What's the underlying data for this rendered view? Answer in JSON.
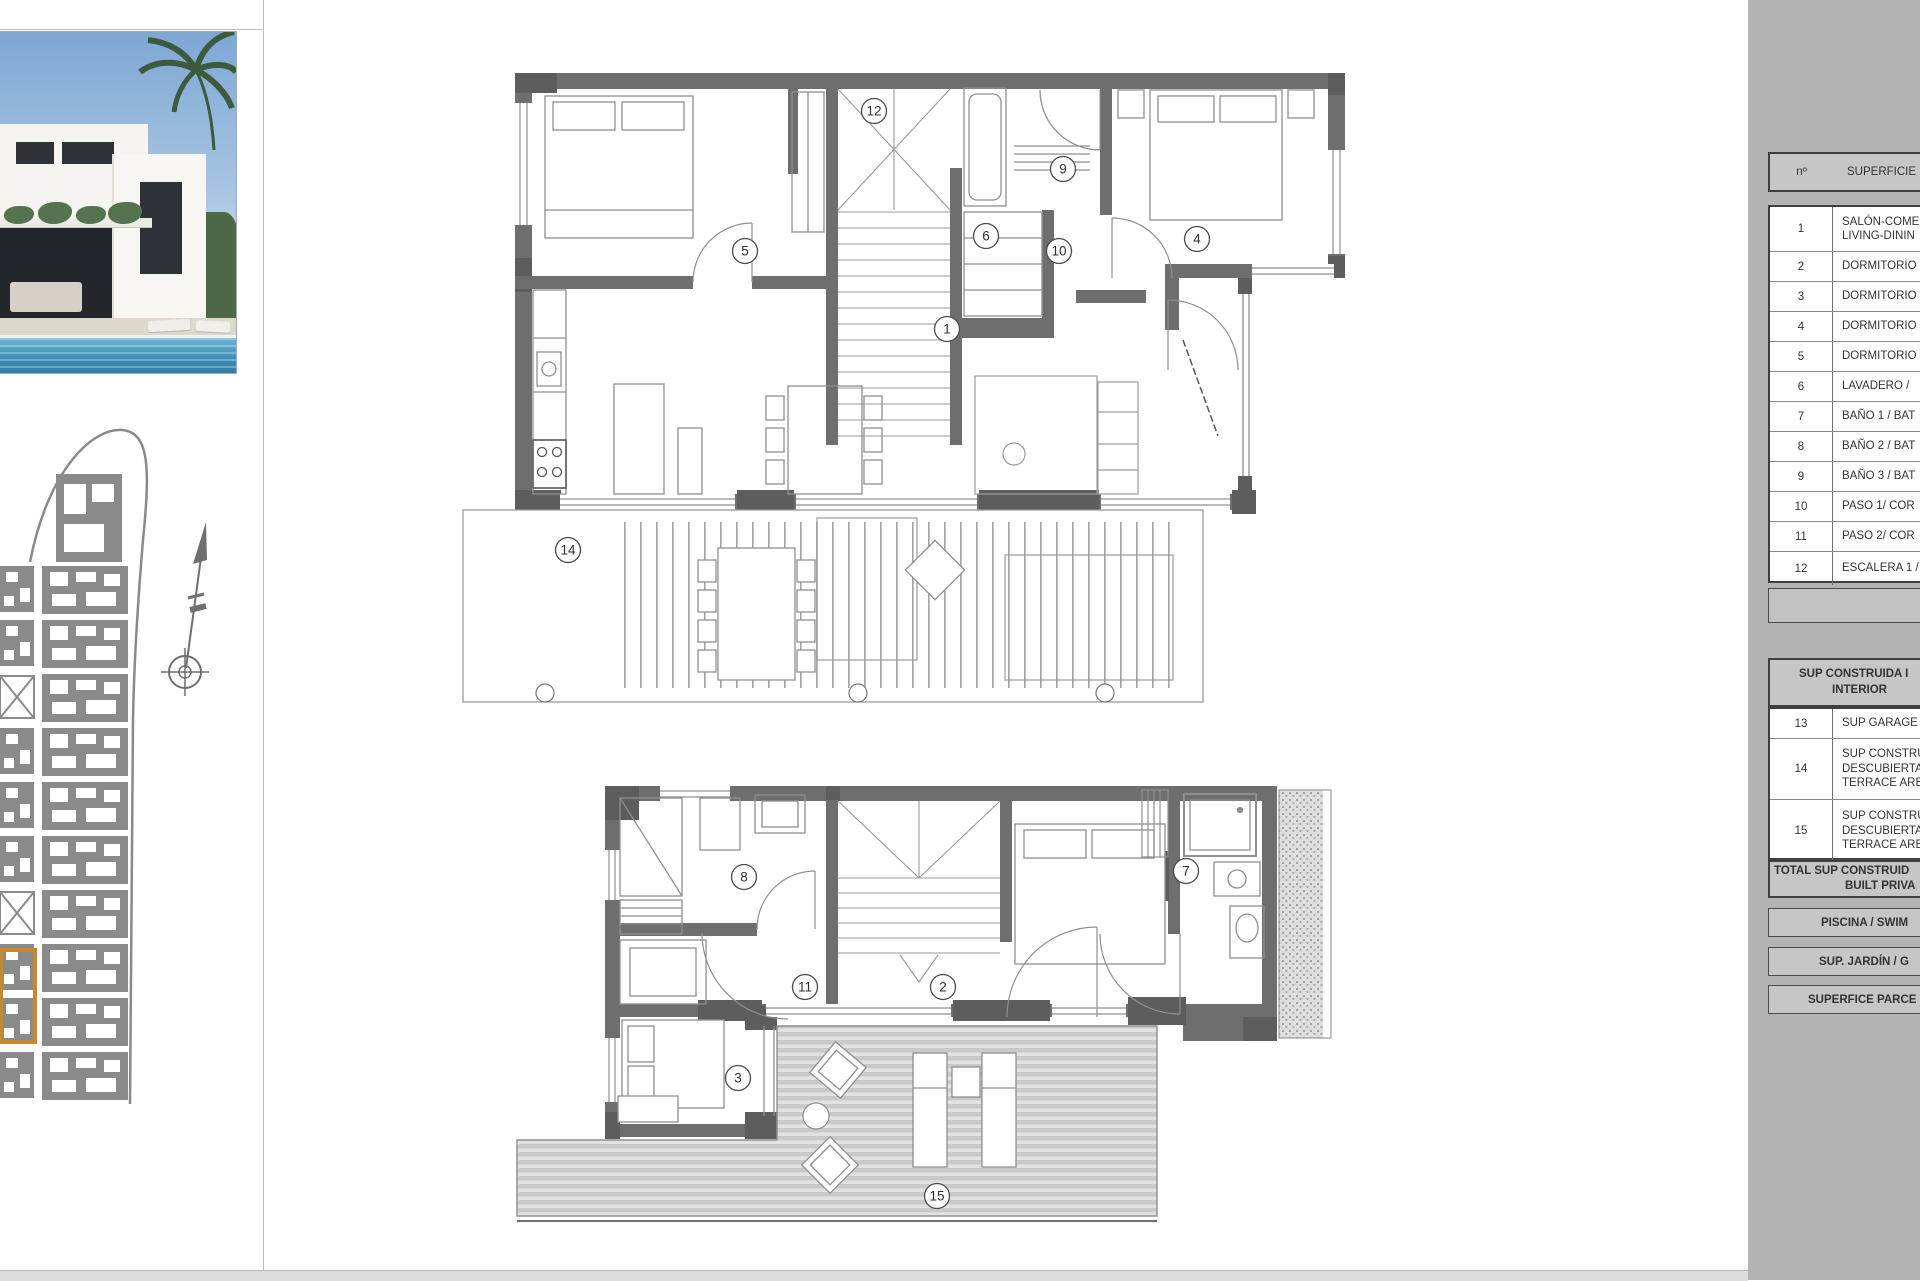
{
  "legend_table": {
    "header": {
      "num": "nº",
      "label": "SUPERFICIE Ú"
    },
    "rows": [
      {
        "num": "1",
        "lines": [
          "SALÓN-COME",
          "LIVING-DININ"
        ]
      },
      {
        "num": "2",
        "lines": [
          "DORMITORIO"
        ]
      },
      {
        "num": "3",
        "lines": [
          "DORMITORIO"
        ]
      },
      {
        "num": "4",
        "lines": [
          "DORMITORIO"
        ]
      },
      {
        "num": "5",
        "lines": [
          "DORMITORIO"
        ]
      },
      {
        "num": "6",
        "lines": [
          "LAVADERO /"
        ]
      },
      {
        "num": "7",
        "lines": [
          "BAÑO 1 / BAT"
        ]
      },
      {
        "num": "8",
        "lines": [
          "BAÑO 2 / BAT"
        ]
      },
      {
        "num": "9",
        "lines": [
          "BAÑO 3 / BAT"
        ]
      },
      {
        "num": "10",
        "lines": [
          "PASO 1/ COR"
        ]
      },
      {
        "num": "11",
        "lines": [
          "PASO 2/ COR"
        ]
      },
      {
        "num": "12",
        "lines": [
          "ESCALERA 1 /"
        ]
      }
    ],
    "section2_header_lines": [
      "SUP CONSTRUIDA I",
      "INTERIOR"
    ],
    "rows2": [
      {
        "num": "13",
        "lines": [
          "SUP GARAGE"
        ]
      },
      {
        "num": "14",
        "lines": [
          "SUP CONSTRU",
          "DESCUBIERTA",
          "TERRACE ARE"
        ]
      },
      {
        "num": "15",
        "lines": [
          "SUP CONSTRU",
          "DESCUBIERTA",
          "TERRACE ARE"
        ]
      }
    ],
    "total_lines": [
      "TOTAL SUP CONSTRUID",
      "BUILT PRIVA"
    ],
    "footer_boxes": [
      "PISCINA / SWIM",
      "SUP. JARDÍN / G",
      "SUPERFICE PARCE"
    ]
  },
  "plan_labels": {
    "r1": "1",
    "r2": "2",
    "r3": "3",
    "r4": "4",
    "r5": "5",
    "r6": "6",
    "r7": "7",
    "r8": "8",
    "r9": "9",
    "r10": "10",
    "r11": "11",
    "r12": "12",
    "r13": "13",
    "r14": "14",
    "r15": "15"
  },
  "colors": {
    "wall": "#6e6e6e",
    "site": "#8a8a8a",
    "highlight": "#c8882e",
    "panel": "#b3b3b3"
  }
}
